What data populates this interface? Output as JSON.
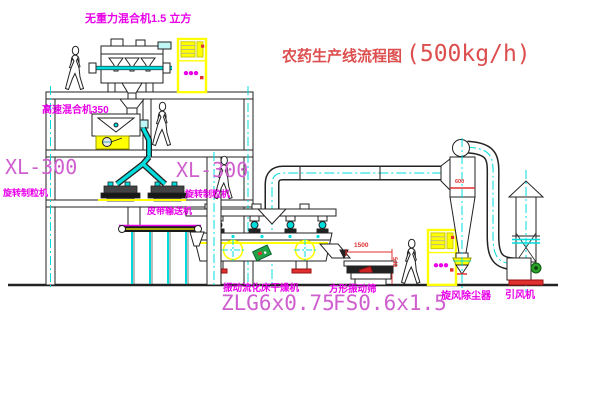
{
  "title": {
    "name": "农药生产线流程图",
    "capacity": "(500kg/h)"
  },
  "equipment": {
    "gravity_mixer": {
      "label": "无重力混合机1.5 立方"
    },
    "high_speed_mixer": {
      "label": "高速混合机350"
    },
    "granulator_left": {
      "model": "XL-300",
      "name": "旋转制粒机"
    },
    "granulator_right": {
      "model": "XL-300",
      "name": "旋转制粒机"
    },
    "belt_conveyor": {
      "name": "皮带输送机"
    },
    "fluid_bed_dryer": {
      "name": "振动流化床干燥机",
      "model": "ZLG6x0.75"
    },
    "vibrating_screen": {
      "name": "方形振动筛",
      "model": "FS0.6x1.5"
    },
    "cyclone": {
      "name": "旋风除尘器"
    },
    "fan": {
      "name": "引风机"
    }
  },
  "dimensions": {
    "screen_length": "1500",
    "screen_height": "540",
    "cyclone_diameter": "600"
  },
  "colors": {
    "line": "#222222",
    "centerline_cyan": "#00dcdc",
    "highlight_yellow": "#ffff00",
    "label_magenta": "#e800e8",
    "model_magenta": "#cf5fcf",
    "title_red": "#dd4f4f",
    "dimension_red": "#e03030",
    "base_red": "#e03030",
    "motor_green": "#2aa02a"
  }
}
